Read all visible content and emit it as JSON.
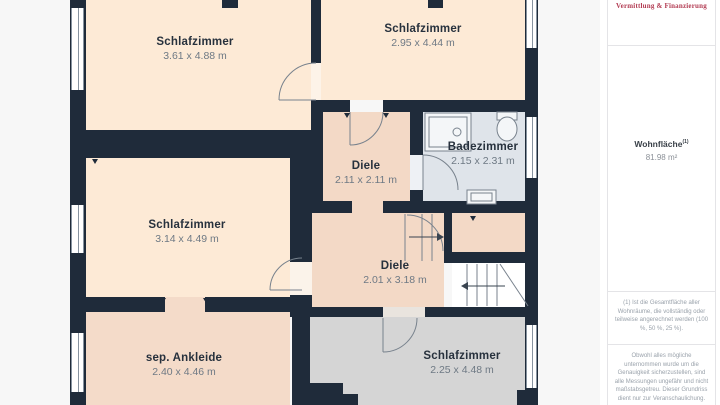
{
  "page": {
    "background": "#f7f7f7",
    "type": "floorplan"
  },
  "colors": {
    "wall": "#1f2b3a",
    "room_peach": "#fdead6",
    "room_tan": "#f3d9c6",
    "room_tan_dressing": "#f4dbc9",
    "room_bath": "#dfe4ea",
    "room_gray": "#d5d5d5",
    "accent_red": "#b23b52",
    "label_dark": "#27313d",
    "label_dim": "#6e7984"
  },
  "rooms": [
    {
      "name": "Schlafzimmer",
      "dims": "3.61 x 4.88 m"
    },
    {
      "name": "Schlafzimmer",
      "dims": "2.95 x 4.44 m"
    },
    {
      "name": "Diele",
      "dims": "2.11 x 2.11 m"
    },
    {
      "name": "Badezimmer",
      "dims": "2.15 x 2.31 m"
    },
    {
      "name": "Schlafzimmer",
      "dims": "3.14 x 4.49 m"
    },
    {
      "name": "Diele",
      "dims": "2.01 x 3.18 m"
    },
    {
      "name": "sep. Ankleide",
      "dims": "2.40 x 4.46 m"
    },
    {
      "name": "Schlafzimmer",
      "dims": "2.25 x 4.48 m"
    }
  ],
  "sidebar": {
    "logo_text": "Vermittlung & Finanzierung",
    "area_label": "Wohnfläche",
    "area_sup": "(1)",
    "area_value": "81.98 m²",
    "footnote1": "(1) Ist die Gesamtfläche aller Wohnräume, die vollständig oder teilweise angerechnet werden (100 %, 50 %, 25 %).",
    "footnote2": "Obwohl alles mögliche unternommen wurde um die Genauigkeit sicherzustellen, sind alle Messungen ungefähr und nicht maßstabsgetreu. Dieser Grundriss dient nur zur Veranschaulichung."
  }
}
